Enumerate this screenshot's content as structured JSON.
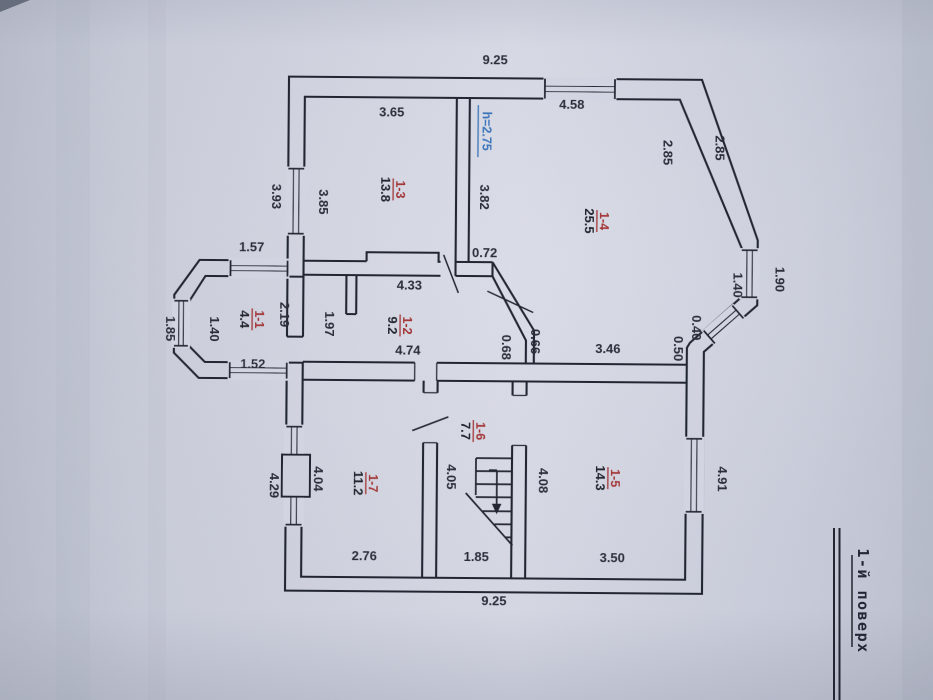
{
  "palette": {
    "paper": "#ced1dd",
    "paper_light": "#dcdee8",
    "paper_dark": "#b6bac8",
    "ink": "#232630",
    "red": "#a33636",
    "blue": "#3a74ba",
    "text": "#2b2e3a"
  },
  "title_block": {
    "floor_label": "1-й поверх"
  },
  "height_note": {
    "text": "h=2.75"
  },
  "rooms": [
    {
      "number": "1-1",
      "area": "4.4"
    },
    {
      "number": "1-2",
      "area": "9.2"
    },
    {
      "number": "1-3",
      "area": "13.8"
    },
    {
      "number": "1-4",
      "area": "25.5"
    },
    {
      "number": "1-5",
      "area": "14.3"
    },
    {
      "number": "1-6",
      "area": "7.7"
    },
    {
      "number": "1-7",
      "area": "11.2"
    }
  ],
  "dimensions": [
    {
      "id": "top_overall",
      "text": "9.25"
    },
    {
      "id": "r13_width",
      "text": "3.65"
    },
    {
      "id": "r14_width",
      "text": "4.58"
    },
    {
      "id": "r13_left_out",
      "text": "3.93"
    },
    {
      "id": "r13_left_in",
      "text": "3.85"
    },
    {
      "id": "r13_right",
      "text": "3.82"
    },
    {
      "id": "r14_diag_in",
      "text": "2.85"
    },
    {
      "id": "r14_diag_out",
      "text": "2.85"
    },
    {
      "id": "bay_top",
      "text": "1.57"
    },
    {
      "id": "seg_072",
      "text": "0.72"
    },
    {
      "id": "r12_top",
      "text": "4.33"
    },
    {
      "id": "r12_bottom",
      "text": "4.74"
    },
    {
      "id": "r15_top",
      "text": "3.46"
    },
    {
      "id": "diag_out",
      "text": "0.68"
    },
    {
      "id": "diag_in",
      "text": "0.66"
    },
    {
      "id": "rbay_in",
      "text": "1.40"
    },
    {
      "id": "rbay_out",
      "text": "1.90"
    },
    {
      "id": "rbay_small_in",
      "text": "0.40"
    },
    {
      "id": "rbay_small_out",
      "text": "0.50"
    },
    {
      "id": "bay_left_out",
      "text": "1.85"
    },
    {
      "id": "bay_left_in",
      "text": "1.40"
    },
    {
      "id": "bay_bottom",
      "text": "1.52"
    },
    {
      "id": "r11_h",
      "text": "2.19"
    },
    {
      "id": "r11_w",
      "text": "1.97"
    },
    {
      "id": "r17_left_in",
      "text": "4.04"
    },
    {
      "id": "r17_left_out",
      "text": "4.29"
    },
    {
      "id": "r16_left",
      "text": "4.05"
    },
    {
      "id": "r15_left",
      "text": "4.08"
    },
    {
      "id": "r17_width",
      "text": "2.76"
    },
    {
      "id": "r16_width",
      "text": "1.85"
    },
    {
      "id": "r15_width",
      "text": "3.50"
    },
    {
      "id": "r15_right_out",
      "text": "4.91"
    },
    {
      "id": "bottom_overall",
      "text": "9.25"
    }
  ]
}
